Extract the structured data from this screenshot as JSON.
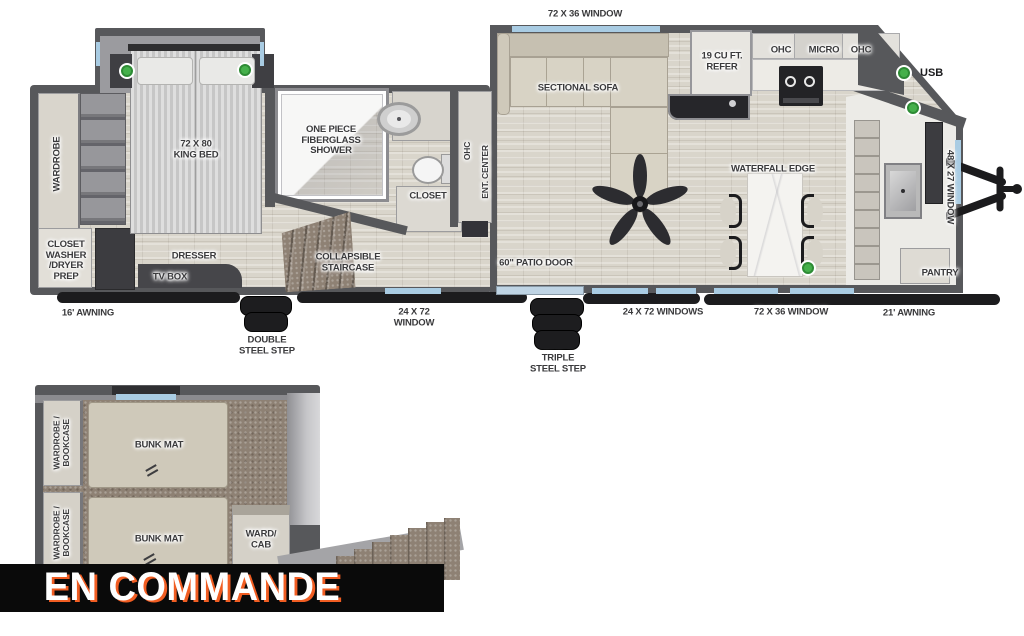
{
  "banner": {
    "text": "EN COMMANDE"
  },
  "legend": {
    "usb": "USB"
  },
  "colors": {
    "wall": "#57585b",
    "window_glass": "#a9cce3",
    "usb_dot_green": "#45b04b",
    "banner_bg": "#0a0a0a",
    "banner_text": "#ffffff",
    "banner_shadow_orange": "#f15d22",
    "wood_floor": "#d9d5cb",
    "carpet": "#8e8174"
  },
  "main": {
    "bedroom": {
      "king_bed": "72 X 80\nKING BED",
      "wardrobe": "WARDROBE",
      "closet_washer": "CLOSET\nWASHER\n/DRYER\nPREP",
      "dresser": "DRESSER",
      "tv_box": "TV BOX"
    },
    "bath": {
      "shower": "ONE PIECE\nFIBERGLASS\nSHOWER",
      "closet": "CLOSET"
    },
    "living": {
      "sofa": "SECTIONAL SOFA",
      "ohc": "OHC",
      "ent_center": "ENT. CENTER",
      "staircase": "COLLAPSIBLE\nSTAIRCASE"
    },
    "kitchen": {
      "refer": "19 CU FT.\nREFER",
      "ohc_left": "OHC",
      "micro": "MICRO",
      "ohc_right": "OHC",
      "waterfall": "WATERFALL EDGE",
      "pantry": "PANTRY"
    },
    "exterior": {
      "top_window": "72 X 36 WINDOW",
      "awning_left": "16' AWNING",
      "double_step": "DOUBLE\nSTEEL STEP",
      "window_24x72": "24 X 72\nWINDOW",
      "patio_door": "60\" PATIO DOOR",
      "triple_step": "TRIPLE\nSTEEL STEP",
      "windows_24x72": "24 X 72 WINDOWS",
      "window_72x36": "72 X 36 WINDOW",
      "awning_right": "21' AWNING",
      "window_48x27": "48 X 27 WINDOW"
    }
  },
  "loft": {
    "wardrobe_bookcase_1": "WARDROBE /\nBOOKCASE",
    "wardrobe_bookcase_2": "WARDROBE /\nBOOKCASE",
    "bunk_mat_1": "BUNK MAT",
    "bunk_mat_2": "BUNK MAT",
    "ward_cab": "WARD/\nCAB"
  }
}
